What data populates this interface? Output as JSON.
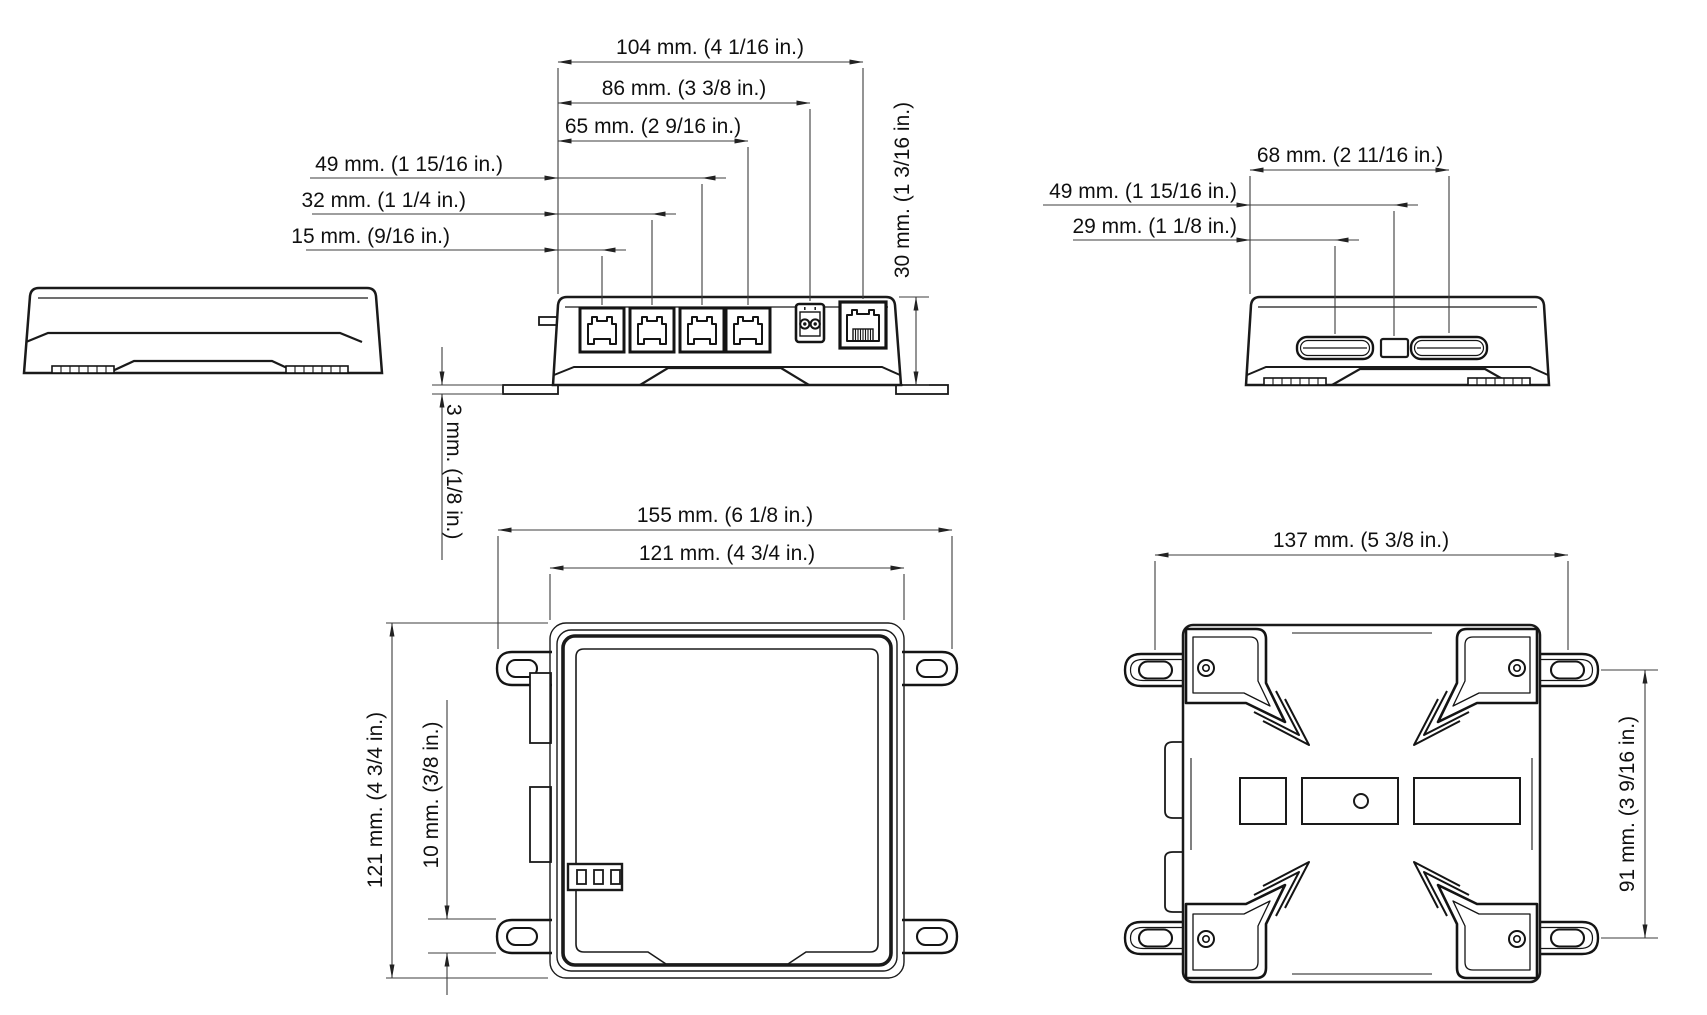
{
  "front": {
    "dims": {
      "w104": "104 mm. (4 1/16 in.)",
      "w86": "86 mm. (3 3/8 in.)",
      "w65": "65 mm. (2 9/16 in.)",
      "w49": "49 mm. (1 15/16 in.)",
      "w32": "32 mm. (1 1/4 in.)",
      "w15": "15 mm. (9/16 in.)",
      "h30": "30 mm. (1 3/16 in.)",
      "t3": "3 mm. (1/8 in.)"
    }
  },
  "side": {
    "dims": {
      "w68": "68 mm. (2 11/16 in.)",
      "w49": "49 mm. (1 15/16 in.)",
      "w29": "29 mm. (1 1/8 in.)"
    }
  },
  "top": {
    "dims": {
      "w155": "155 mm. (6 1/8 in.)",
      "w121": "121 mm. (4 3/4 in.)",
      "h121": "121 mm. (4 3/4 in.)",
      "h10": "10 mm. (3/8 in.)"
    }
  },
  "bottom": {
    "dims": {
      "w137": "137 mm. (5 3/8 in.)",
      "h91": "91 mm. (3 9/16 in.)"
    }
  },
  "colors": {
    "line": "#1a1a1a",
    "dim": "#3c3c3c",
    "background": "#ffffff"
  }
}
